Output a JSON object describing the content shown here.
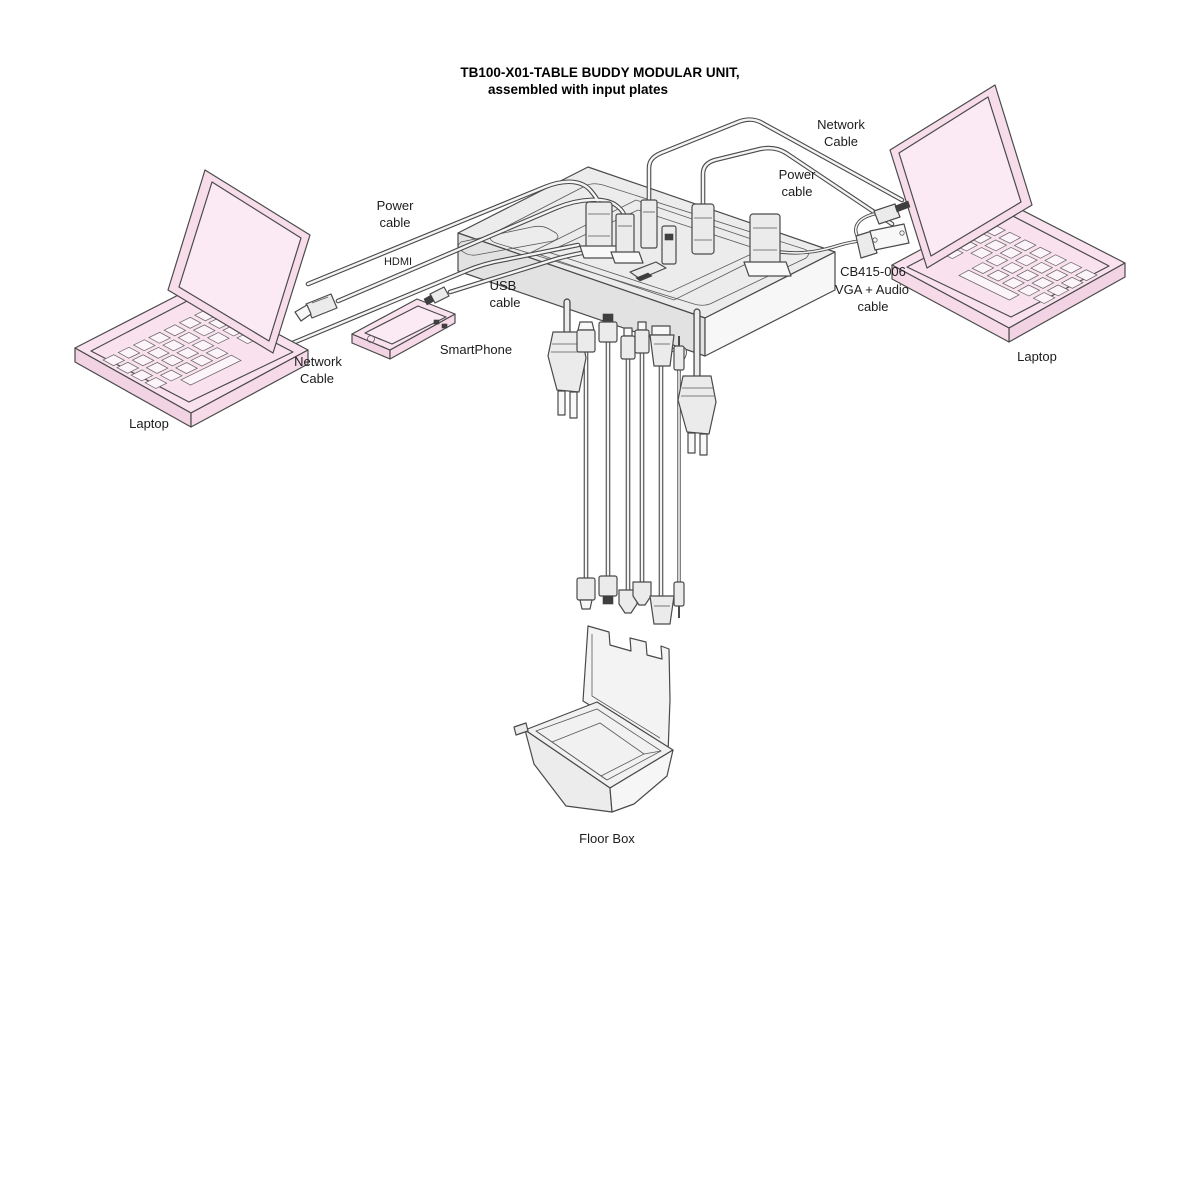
{
  "title": {
    "line1": "TB100-X01-TABLE BUDDY  MODULAR UNIT,",
    "line2": "assembled with input plates"
  },
  "labels": {
    "power_cable_left": {
      "line1": "Power",
      "line2": "cable"
    },
    "hdmi": "HDMI",
    "usb_cable": {
      "line1": "USB",
      "line2": "cable"
    },
    "smartphone": "SmartPhone",
    "network_cable_left": {
      "line1": "Network",
      "line2": "Cable"
    },
    "laptop_left": "Laptop",
    "network_cable_right": {
      "line1": "Network",
      "line2": "Cable"
    },
    "power_cable_right": {
      "line1": "Power",
      "line2": "cable"
    },
    "vga_audio_cable": {
      "line1": "CB415-006",
      "line2": "VGA + Audio",
      "line3": "cable"
    },
    "laptop_right": "Laptop",
    "floor_box": "Floor Box"
  },
  "components": {
    "table_unit": "table-buddy-modular-unit",
    "laptops": 2,
    "smartphone": 1,
    "floor_box": 1
  },
  "colors": {
    "outline": "#4a4a4a",
    "laptop_pink": "#f9e2ee",
    "laptop_pink_light": "#fbeaf3",
    "surface_gray": "#ececec",
    "cable_core": "#f4f4f4",
    "text": "#1c1c1c",
    "background": "#ffffff"
  }
}
